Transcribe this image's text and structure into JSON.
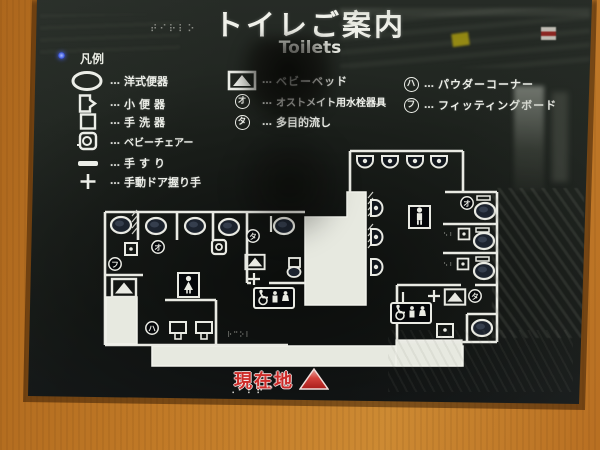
{
  "sign": {
    "title": "トイレご案内",
    "subtitle": "Toilets",
    "legend": {
      "header": "凡例",
      "separator": "…",
      "left": [
        {
          "icon": "western-toilet-icon",
          "label": "洋式便器"
        },
        {
          "icon": "urinal-icon",
          "label": "小便器"
        },
        {
          "icon": "hand-basin-icon",
          "label": "手洗器"
        },
        {
          "icon": "baby-chair-icon",
          "label": "ベビーチェアー"
        },
        {
          "icon": "handrail-icon",
          "label": "手すり"
        },
        {
          "icon": "manual-door-handle-icon",
          "label": "手動ドア握り手"
        }
      ],
      "middle": [
        {
          "icon": "baby-bed-icon",
          "label": "ベビーベッド"
        },
        {
          "icon": "circled-letter-icon",
          "symbol": "オ",
          "label": "オストメイト用水栓器具"
        },
        {
          "icon": "circled-letter-icon",
          "symbol": "タ",
          "label": "多目的流し"
        }
      ],
      "right": [
        {
          "icon": "circled-letter-icon",
          "symbol": "ハ",
          "label": "パウダーコーナー"
        },
        {
          "icon": "circled-letter-icon",
          "symbol": "フ",
          "label": "フィッティングボード"
        }
      ]
    },
    "map": {
      "markers": {
        "ostomate": "オ",
        "multipurpose_sink": "タ",
        "powder_corner": "ハ",
        "fitting_board": "フ"
      }
    },
    "current_location": {
      "label": "現在地"
    },
    "decor": {
      "braille_title": "⠞⠊⠗⠇⠕",
      "braille_bottom": "⠠⠃⠇⠗⠉",
      "braille_corridor": "⠗⠉⠕⠇",
      "braille_stall": "⠢⠆"
    },
    "colors": {
      "wood": "#c17a27",
      "sign_background": "#1d211e",
      "line": "#e9eae3",
      "location_red": "#cc2b28"
    }
  }
}
